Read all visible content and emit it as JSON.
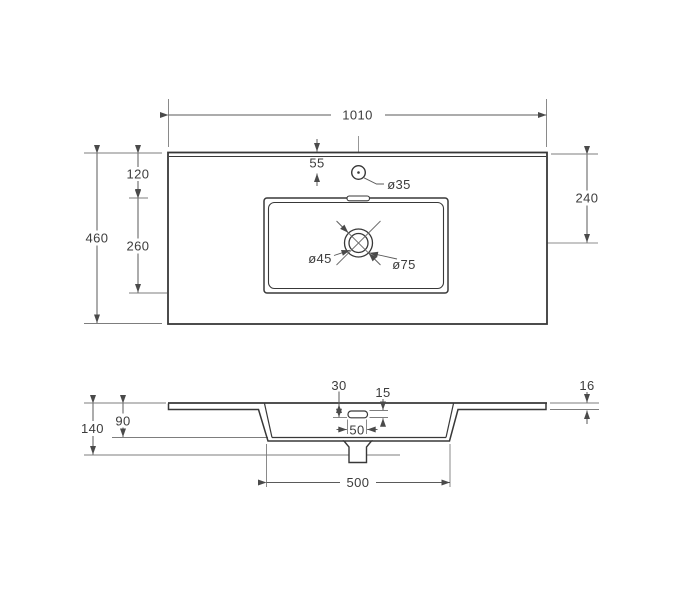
{
  "drawing": {
    "type": "washbasin-countertop-dimensional-drawing",
    "background": "#ffffff",
    "line_color": "#383838",
    "dim_line_color": "#5a5a5a",
    "ref_line_color": "#7d7d7d",
    "text_color": "#3c3c3c"
  },
  "plan_view": {
    "overall_width": "1010",
    "overall_depth": "460",
    "back_edge_to_basin": "120",
    "basin_front_back": "260",
    "faucet_offset_from_back": "55",
    "faucet_hole_diameter": "ø35",
    "drain_inner_diameter": "ø45",
    "drain_outer_diameter": "ø75",
    "back_edge_to_drain_center": "240"
  },
  "section_view": {
    "overflow_bottom_from_top": "30",
    "overflow_slot_height": "15",
    "slab_thickness": "16",
    "basin_inner_depth": "90",
    "total_height": "140",
    "overflow_slot_width": "50",
    "basin_outer_width": "500"
  }
}
